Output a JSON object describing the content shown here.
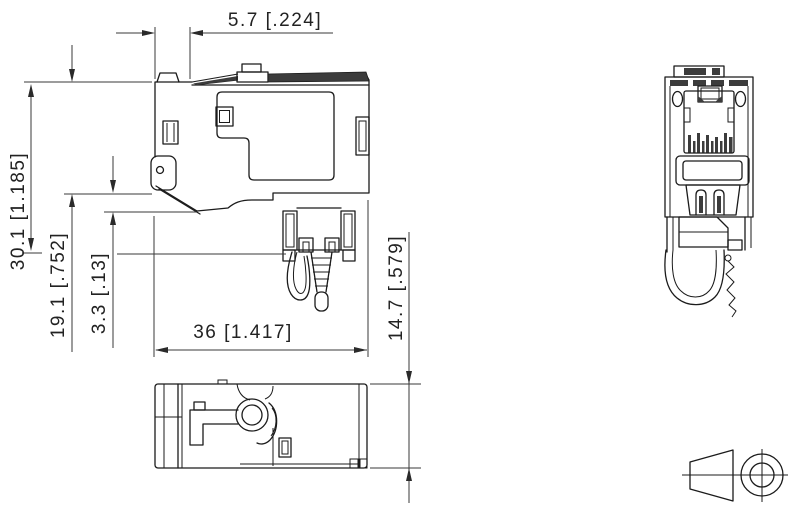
{
  "page": {
    "background": "#ffffff",
    "line_color": "#1b1b1b",
    "shade_color": "#3c3c3c",
    "description_kind": "technical dimension drawing, RJ45 field plug / keystone connector, three orthographic views plus projection symbol"
  },
  "drawing": {
    "dimensions": {
      "latch_offset_top": "5.7 [.224]",
      "overall_height": "30.1 [1.185]",
      "housing_height": "19.1 [.752]",
      "latch_step": "3.3 [.13]",
      "overall_width": "36 [1.417]",
      "body_depth": "14.7 [.579]"
    }
  }
}
